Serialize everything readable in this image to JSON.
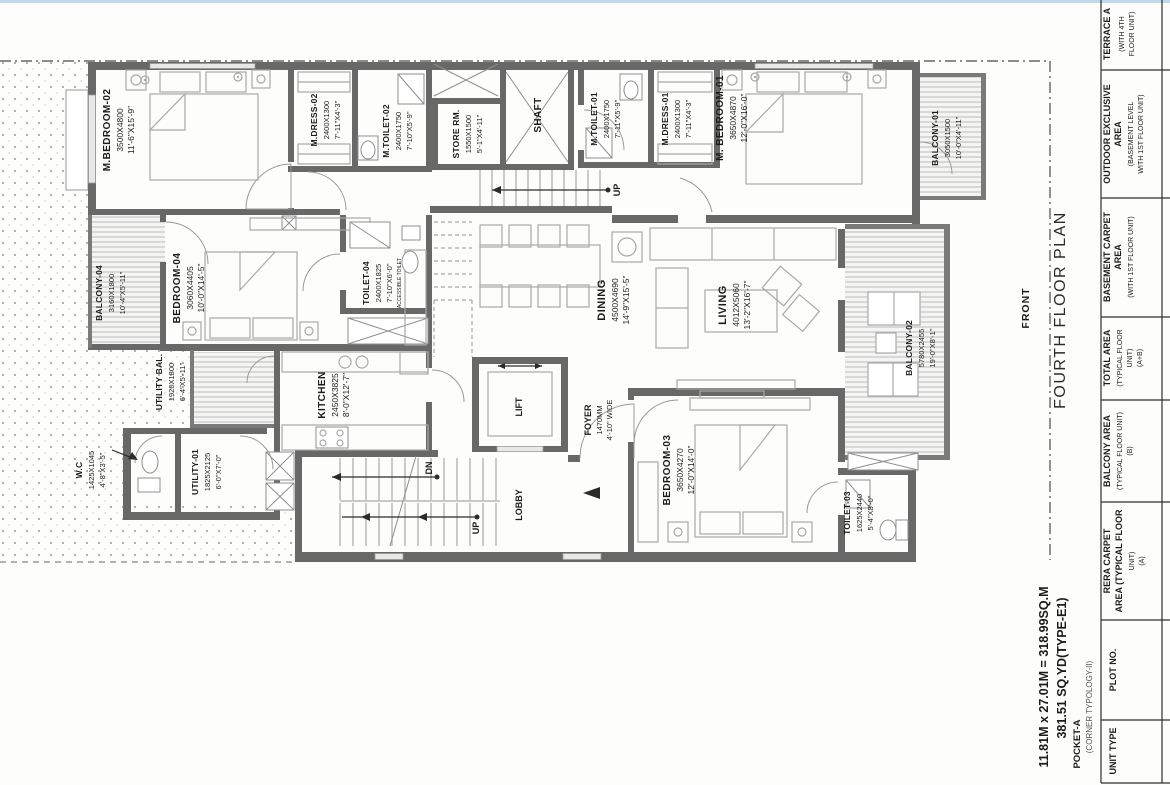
{
  "sheet": {
    "title": "FOURTH FLOOR PLAN",
    "front_label": "FRONT"
  },
  "footer": {
    "dim_line": "11.81M x 27.01M = 318.99SQ.M",
    "yd_line": "381.51 SQ.YD(TYPE-E1)",
    "pocket": "POCKET-A",
    "typology": "(CORNER TYPOLOGY-II)"
  },
  "stairs": {
    "up": "UP",
    "dn": "DN"
  },
  "rooms": {
    "m_bedroom_02": {
      "name": "M.BEDROOM-02",
      "mm": "3500X4800",
      "ft": "11'-6\"X15'-9\""
    },
    "m_dress_02": {
      "name": "M.DRESS-02",
      "mm": "2400X1300",
      "ft": "7'-11\"X4'-3\""
    },
    "m_toilet_02": {
      "name": "M.TOILET-02",
      "mm": "2400X1750",
      "ft": "7'-10\"X5'-9\""
    },
    "store_rm": {
      "name": "STORE RM.",
      "mm": "1550X1500",
      "ft": "5'-1\"X4'-11\""
    },
    "shaft": {
      "name": "SHAFT"
    },
    "m_toilet_01": {
      "name": "M.TOILET-01",
      "mm": "2400X1750",
      "ft": "7'-11\"X5'-9\""
    },
    "m_dress_01": {
      "name": "M.DRESS-01",
      "mm": "2400X1300",
      "ft": "7'-11\"X4'-3\""
    },
    "m_bedroom_01": {
      "name": "M. BEDROOM-01",
      "mm": "3650X4870",
      "ft": "12'-0\"X16'-0\""
    },
    "balcony_01": {
      "name": "BALCONY-01",
      "mm": "3050X1500",
      "ft": "10'-0\"X4'-11\""
    },
    "balcony_04": {
      "name": "BALCONY-04",
      "mm": "3160X1800",
      "ft": "10'-4\"X5'-11\""
    },
    "bedroom_04": {
      "name": "BEDROOM-04",
      "mm": "3060X4405",
      "ft": "10'-0\"X14'-5\""
    },
    "toilet_04": {
      "name": "TOILET-04",
      "mm": "2400X1825",
      "ft": "7'-10\"X6'-0\"",
      "note": "ACCESSIBLE TOILET"
    },
    "utility_bal": {
      "name": "UTILITY BAL.",
      "mm": "1920X1800",
      "ft": "6'-4\"X5'-11\""
    },
    "kitchen": {
      "name": "KITCHEN",
      "mm": "2450X3825",
      "ft": "8'-0\"X12'-7\""
    },
    "wc": {
      "name": "W.C",
      "mm": "1425X1045",
      "ft": "4'-8\"X3'-5\""
    },
    "utility_01": {
      "name": "UTILITY-01",
      "mm": "1825X2125",
      "ft": "6'-0\"X7'-0\""
    },
    "dining": {
      "name": "DINING",
      "mm": "4500X4690",
      "ft": "14'-9\"X15'-5\""
    },
    "living": {
      "name": "LIVING",
      "mm": "4012X5060",
      "ft": "13'-2\"X16'-7\""
    },
    "balcony_02": {
      "name": "BALCONY-02",
      "mm": "5780X2455",
      "ft": "19'-0\"X8'-1\""
    },
    "lift": {
      "name": "LIFT"
    },
    "foyer": {
      "name": "FOYER",
      "mm": "1470MM",
      "ft": "4'-10\" WIDE"
    },
    "lobby": {
      "name": "LOBBY"
    },
    "bedroom_03": {
      "name": "BEDROOM-03",
      "mm": "3650X4270",
      "ft": "12'-0\"X14'-0\""
    },
    "toilet_03": {
      "name": "TOILET-03",
      "mm": "1625X2440",
      "ft": "5'-4\"X8'-0\""
    }
  },
  "table": {
    "rows": [
      {
        "l1": "TERRACE A",
        "l2": "(WITH 4TH",
        "l3": "FLOOR UNIT)",
        "l4": ""
      },
      {
        "l1": "OUTDOOR EXCLUSIVE",
        "l2": "AREA",
        "l3": "(BASEMENT LEVEL",
        "l4": "WITH 1ST FLOOR UNIT)"
      },
      {
        "l1": "BASEMENT CARPET",
        "l2": "AREA",
        "l3": "(WITH 1ST FLOOR UNIT)",
        "l4": ""
      },
      {
        "l1": "TOTAL AREA",
        "l2": "(TYPICAL FLOOR",
        "l3": "UNIT)",
        "l4": "(A+B)"
      },
      {
        "l1": "BALCONY AREA",
        "l2": "(TYPICAL FLOOR UNIT)",
        "l3": "(B)",
        "l4": ""
      },
      {
        "l1": "RERA CARPET",
        "l2": "AREA (TYPICAL FLOOR",
        "l3": "UNIT)",
        "l4": "(A)"
      },
      {
        "l1": "PLOT NO.",
        "l2": "",
        "l3": "",
        "l4": ""
      },
      {
        "l1": "UNIT TYPE",
        "l2": "",
        "l3": "",
        "l4": ""
      }
    ]
  },
  "colors": {
    "wall": "#686868",
    "hatch": "#bdbdbd",
    "dots": "#a8aba6",
    "top_strip": "#c2d9ea",
    "text": "#1c1c1c"
  }
}
